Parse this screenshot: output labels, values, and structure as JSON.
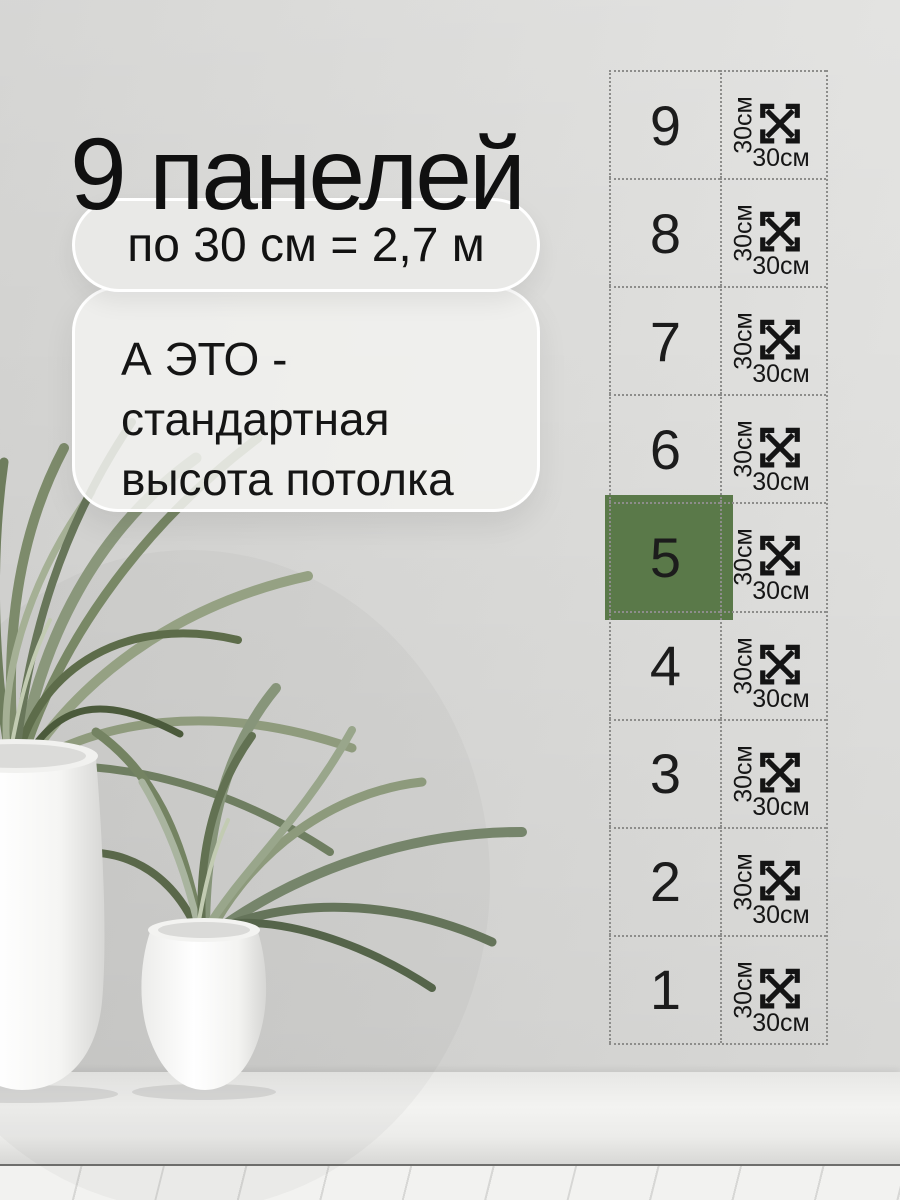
{
  "title": "9 панелей",
  "callout": {
    "pill_text": "по 30 см = 2,7 м",
    "note_lines": [
      "А ЭТО -",
      "стандартная",
      "высота потолка"
    ]
  },
  "panels": {
    "rows": [
      {
        "number": "9",
        "height_label": "30см",
        "width_label": "30см",
        "highlighted": false
      },
      {
        "number": "8",
        "height_label": "30см",
        "width_label": "30см",
        "highlighted": false
      },
      {
        "number": "7",
        "height_label": "30см",
        "width_label": "30см",
        "highlighted": false
      },
      {
        "number": "6",
        "height_label": "30см",
        "width_label": "30см",
        "highlighted": false
      },
      {
        "number": "5",
        "height_label": "30см",
        "width_label": "30см",
        "highlighted": true
      },
      {
        "number": "4",
        "height_label": "30см",
        "width_label": "30см",
        "highlighted": false
      },
      {
        "number": "3",
        "height_label": "30см",
        "width_label": "30см",
        "highlighted": false
      },
      {
        "number": "2",
        "height_label": "30см",
        "width_label": "30см",
        "highlighted": false
      },
      {
        "number": "1",
        "height_label": "30см",
        "width_label": "30см",
        "highlighted": false
      }
    ],
    "icon": "diagonal-resize-arrows-icon",
    "highlight_color": "#5a7949",
    "border_color": "#8d8d8b"
  }
}
